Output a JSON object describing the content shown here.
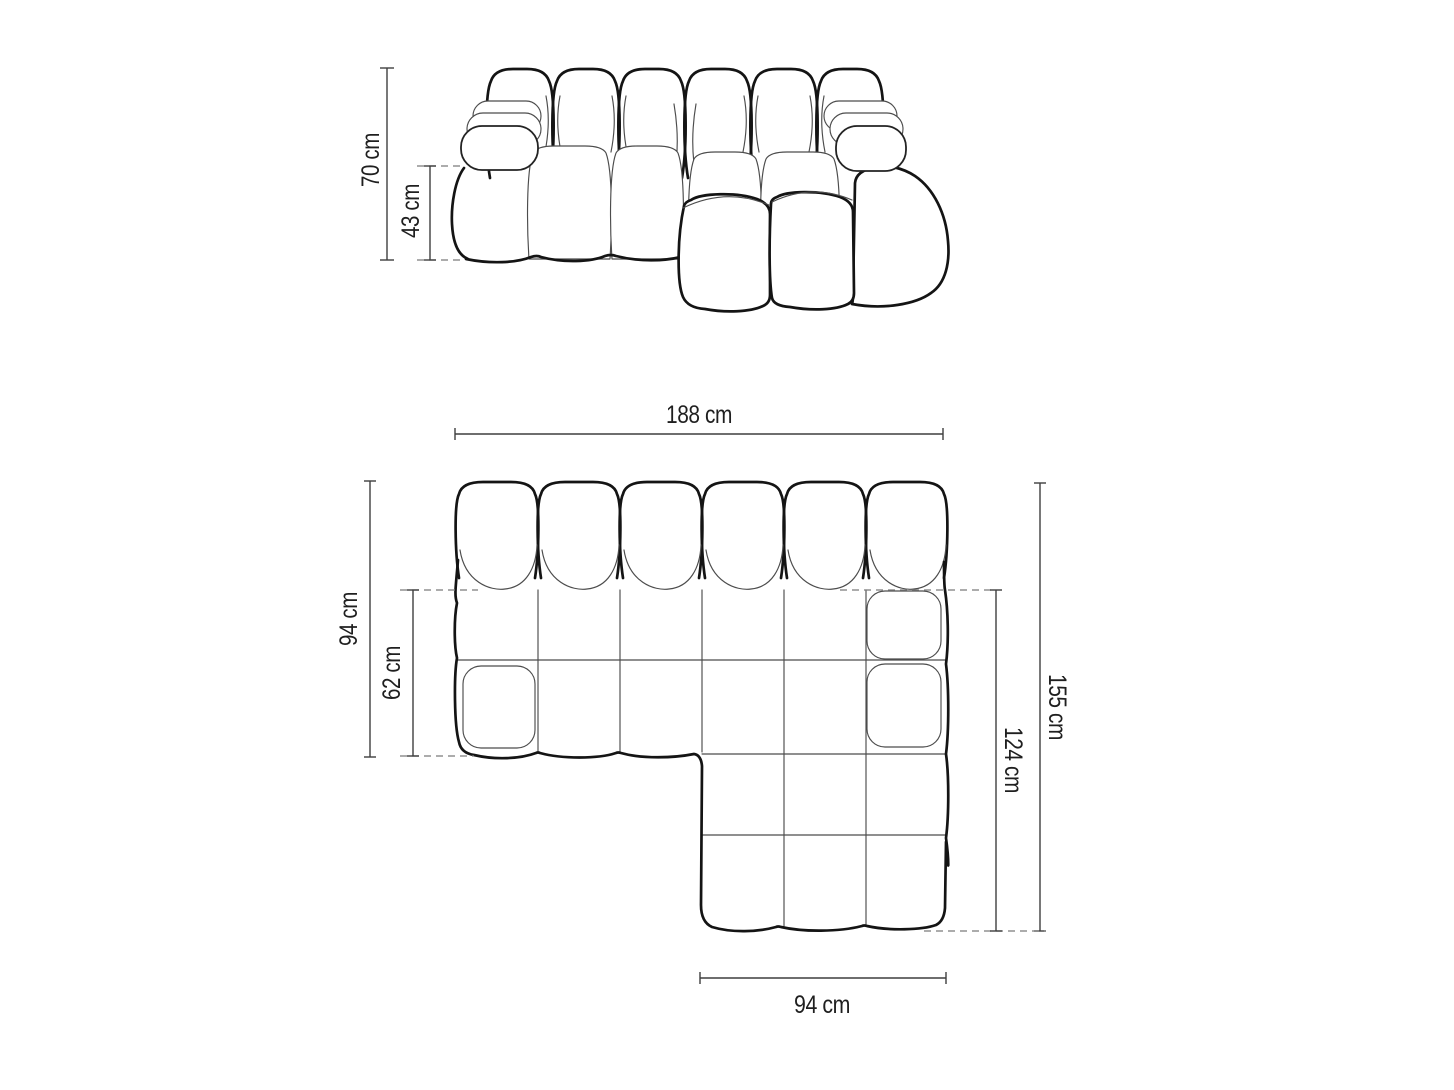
{
  "dimensions": {
    "front_view": {
      "overall_height": "70 cm",
      "seat_height": "43 cm"
    },
    "top_view": {
      "overall_width": "188 cm",
      "sofa_depth": "94 cm",
      "seat_depth": "62 cm",
      "overall_depth": "155 cm",
      "chaise_depth": "124 cm",
      "chaise_width": "94 cm"
    }
  },
  "colors": {
    "background": "#ffffff",
    "outline_bold": "#141414",
    "outline_thin": "#4c4c4c",
    "dimension_line": "#3f3f3f",
    "dashed_line": "#7a7a7a",
    "label_text": "#1f1f1f"
  }
}
